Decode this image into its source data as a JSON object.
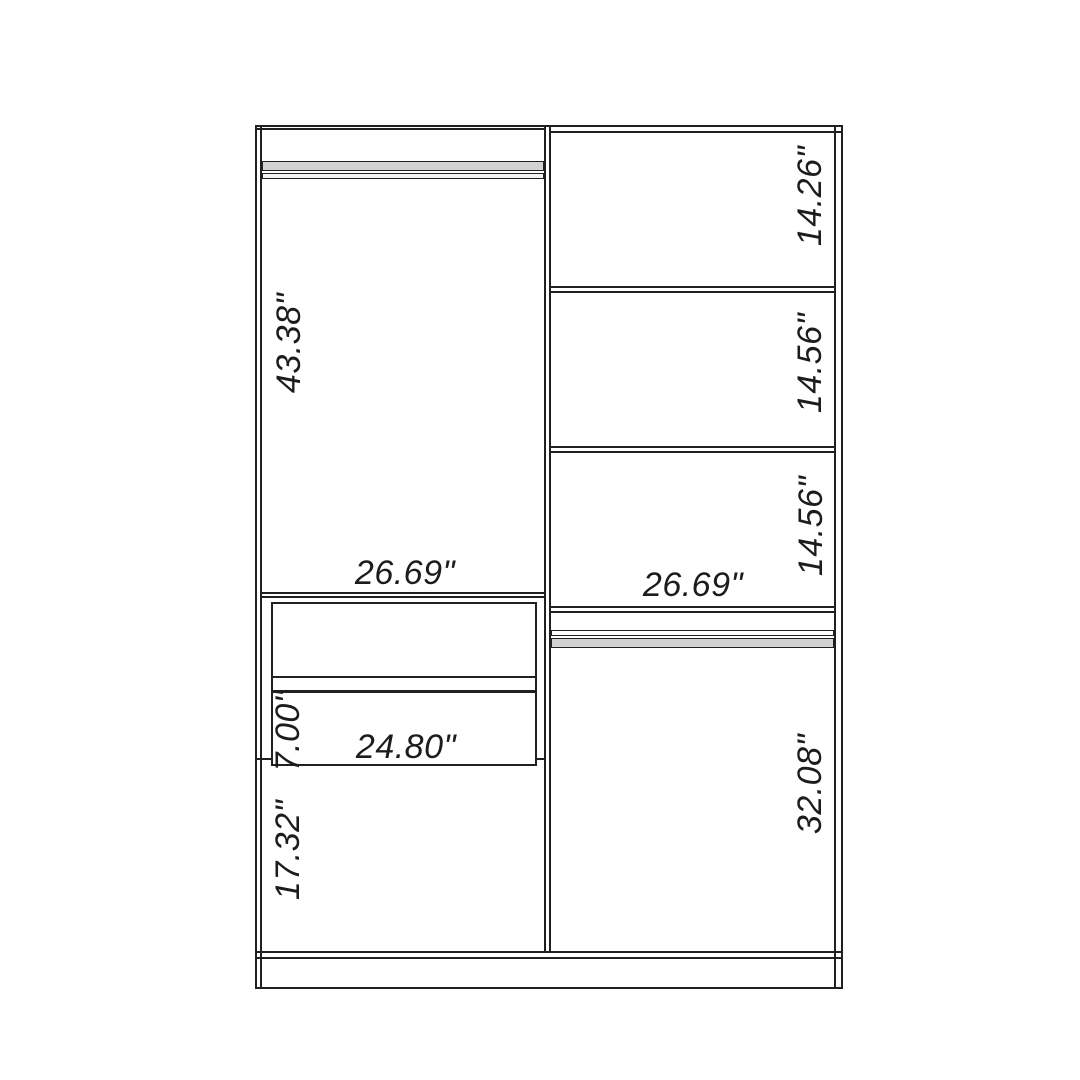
{
  "colors": {
    "background": "#ffffff",
    "line": "#202020",
    "rod_fill": "#d2d2d2"
  },
  "diagram": {
    "left_compartment": {
      "hanging_space_height": "43.38\"",
      "width": "26.69\"",
      "drawer_front_height": "7.00\"",
      "drawer_width": "24.80\"",
      "lower_space_height": "17.32\""
    },
    "right_compartment": {
      "cubby_heights": [
        "14.26\"",
        "14.56\"",
        "14.56\""
      ],
      "width": "26.69\"",
      "hanging_space_height": "32.08\""
    }
  }
}
